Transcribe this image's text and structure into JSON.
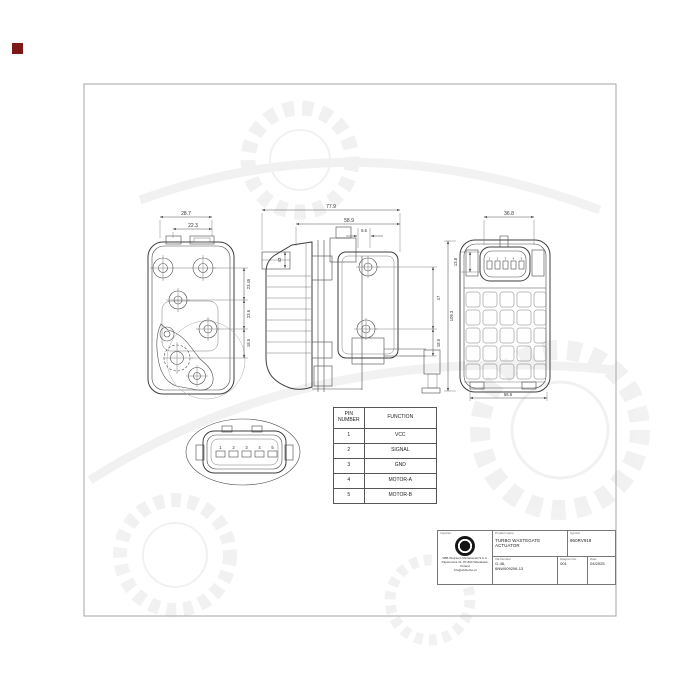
{
  "colors": {
    "background": "#ffffff",
    "frame": "#a6a6a6",
    "line": "#3c3c3c",
    "red_marker": "#7b1818"
  },
  "drawing": {
    "dims": {
      "front_total_width": "28.7",
      "front_inner_width": "22.3",
      "front_span_top": "23.45",
      "front_span_mid": "23.6",
      "front_span_bottom": "18.5",
      "side_total_width": "77.9",
      "side_body_width": "58.9",
      "side_step": "6.5",
      "side_port_height": "43",
      "side_hole_span": "47",
      "side_rod_offset": "18.5",
      "back_connector_width": "36.8",
      "back_connector_height": "13.8",
      "back_total_height": "109.3",
      "back_bottom_width": "56.6"
    },
    "connector_pins": [
      "1",
      "2",
      "3",
      "4",
      "5"
    ]
  },
  "pin_table": {
    "headers": [
      "PIN NUMBER",
      "FUNCTION"
    ],
    "rows": [
      {
        "pin": "1",
        "function": "VCC"
      },
      {
        "pin": "2",
        "function": "SIGNAL"
      },
      {
        "pin": "3",
        "function": "GND"
      },
      {
        "pin": "4",
        "function": "MOTOR-A"
      },
      {
        "pin": "5",
        "function": "MOTOR-B"
      }
    ]
  },
  "title_block": {
    "importer_label": "Importer",
    "importer_lines": [
      "SBB Wojciech Michałowski S.K.A.",
      "Papiernicza 31, 87-800 Włocławek, Poland",
      "info@sbbturbo.pl"
    ],
    "product_name_label": "Product name",
    "product_name": "TURBO WASTEGATE ACTUATOR",
    "symbol_label": "Symbol",
    "symbol": "960RV918",
    "oe_number_label": "OE Number",
    "oe_number_line1": "G-48,",
    "oe_number_line2": "6NW009206-13",
    "diagram_no_label": "Diagram No.",
    "diagram_no": "001",
    "date_label": "Date",
    "date": "04/2025"
  }
}
